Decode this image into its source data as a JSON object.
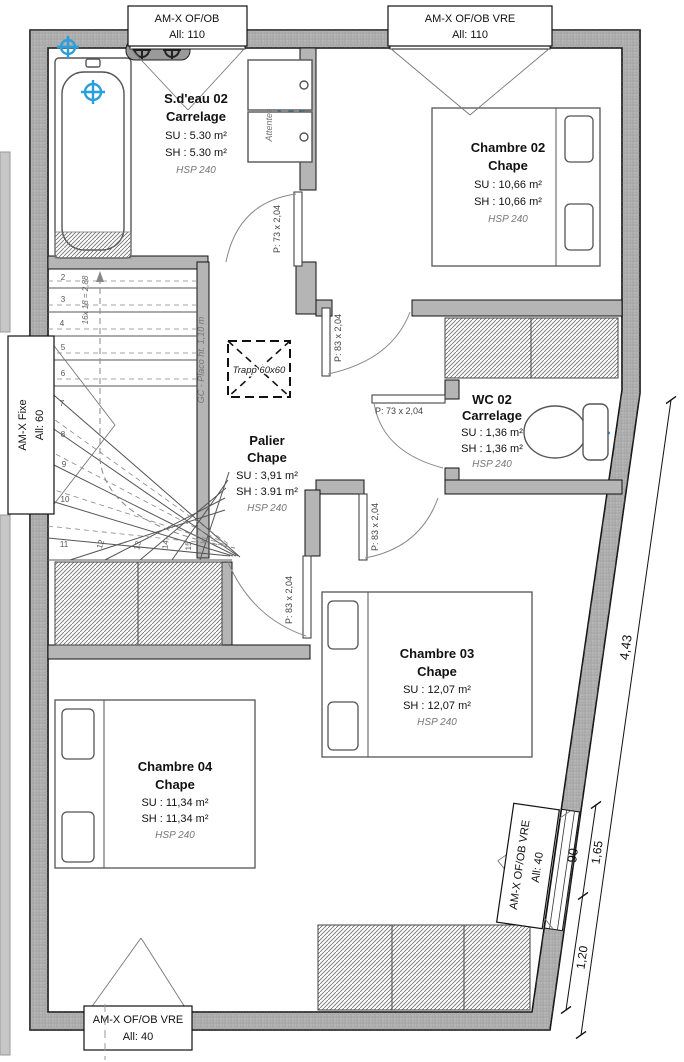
{
  "colors": {
    "wall_fill": "#b5b5b5",
    "line": "#111111",
    "fixture_blue": "#2b9fdc",
    "muted": "#777777"
  },
  "windows": {
    "top_left": {
      "l1": "AM-X OF/OB",
      "l2": "All: 110"
    },
    "top_right": {
      "l1": "AM-X OF/OB VRE",
      "l2": "All: 110"
    },
    "left": {
      "l1": "AM-X Fixe",
      "l2": "All: 60"
    },
    "bottom": {
      "l1": "AM-X OF/OB VRE",
      "l2": "All: 40"
    },
    "right": {
      "l1": "AM-X OF/OB VRE",
      "l2": "All: 40"
    }
  },
  "rooms": {
    "sdeau": {
      "name": "S.d'eau 02",
      "finish": "Carrelage",
      "su": "SU : 5.30 m²",
      "sh": "SH : 5.30 m²",
      "hsp": "HSP 240"
    },
    "ch02": {
      "name": "Chambre 02",
      "finish": "Chape",
      "su": "SU : 10,66 m²",
      "sh": "SH : 10,66 m²",
      "hsp": "HSP 240"
    },
    "wc02": {
      "name": "WC 02",
      "finish": "Carrelage",
      "su": "SU : 1,36 m²",
      "sh": "SH : 1,36 m²",
      "hsp": "HSP 240"
    },
    "palier": {
      "name": "Palier",
      "finish": "Chape",
      "su": "SU : 3,91 m²",
      "sh": "SH : 3.91 m²",
      "hsp": "HSP 240"
    },
    "ch03": {
      "name": "Chambre 03",
      "finish": "Chape",
      "su": "SU : 12,07 m²",
      "sh": "SH : 12,07 m²",
      "hsp": "HSP 240"
    },
    "ch04": {
      "name": "Chambre 04",
      "finish": "Chape",
      "su": "SU : 11,34 m²",
      "sh": "SH : 11,34 m²",
      "hsp": "HSP 240"
    }
  },
  "doors": {
    "sdeau": "P: 73 x 2,04",
    "ch02": "P: 83 x 2,04",
    "wc": "P: 73 x 2,04",
    "ch03": "P: 83 x 2,04",
    "ch04": "P: 83 x 2,04"
  },
  "annotations": {
    "trappe": "Trapp 60x60",
    "gc_placo": "GC - Placo ht. 1,10 m",
    "attentes": "Attentes",
    "stair_formula": "16x 18 = 2,88"
  },
  "dimensions": {
    "total": "4,43",
    "window": "90",
    "seg1": "1,65",
    "seg2": "1,20"
  },
  "stairs": {
    "steps": [
      "2",
      "3",
      "4",
      "5",
      "6",
      "7",
      "8",
      "9",
      "10",
      "11",
      "12",
      "13",
      "14",
      "15"
    ]
  }
}
